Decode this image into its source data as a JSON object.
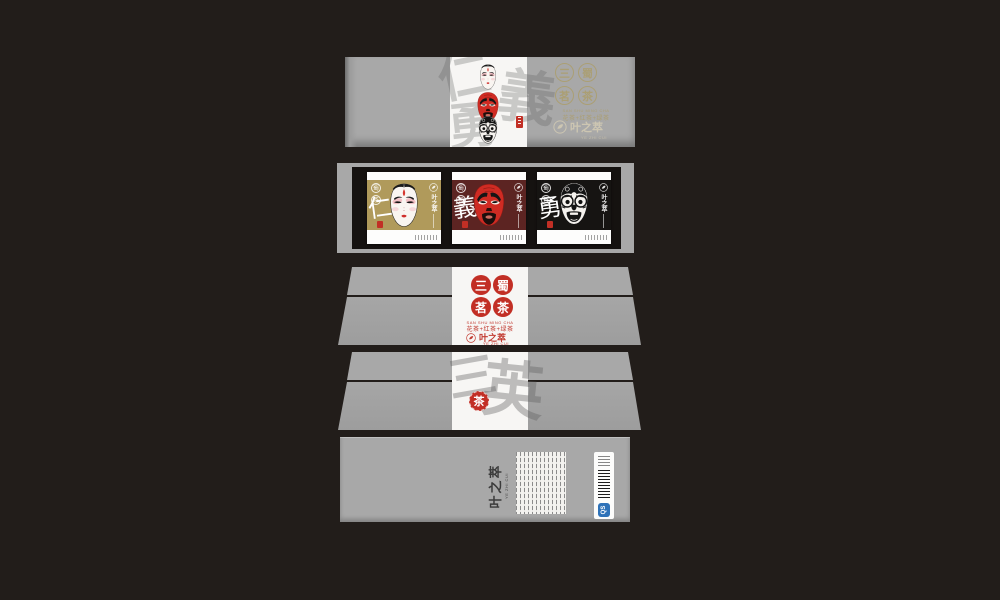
{
  "background": "#221d1a",
  "colors": {
    "panel_gray": "#a8a8a8",
    "accent_red": "#c22f25",
    "gold_text": "#ab9f74",
    "card_gold_bg": "#b09a5b",
    "card_maroon_bg": "#5c2422",
    "card_black_bg": "#161412",
    "frame_black": "#151210",
    "qs_blue": "#2e72b8"
  },
  "brand": {
    "name": "叶之萃",
    "tagline": "YE ZHI CUI"
  },
  "series": {
    "seal_chars": [
      "三",
      "蜀",
      "茗",
      "茶"
    ],
    "english": "SAN SHU MING CHA",
    "subtitle": "花茶+红茶+绿茶"
  },
  "lid_top": {
    "watermark_chars": [
      "仁",
      "義",
      "勇"
    ],
    "masks": [
      "white-face-mask",
      "red-face-mask",
      "black-face-mask"
    ]
  },
  "cards": [
    {
      "virtue": "仁",
      "mask": "white-face-mask",
      "bg": "#b09a5b"
    },
    {
      "virtue": "義",
      "mask": "red-face-mask",
      "bg": "#5c2422"
    },
    {
      "virtue": "勇",
      "mask": "black-face-mask",
      "bg": "#161412"
    }
  ],
  "side_back": {
    "watermark_chars": [
      "三",
      "英"
    ]
  },
  "bottom": {
    "qs_label": "QS"
  }
}
